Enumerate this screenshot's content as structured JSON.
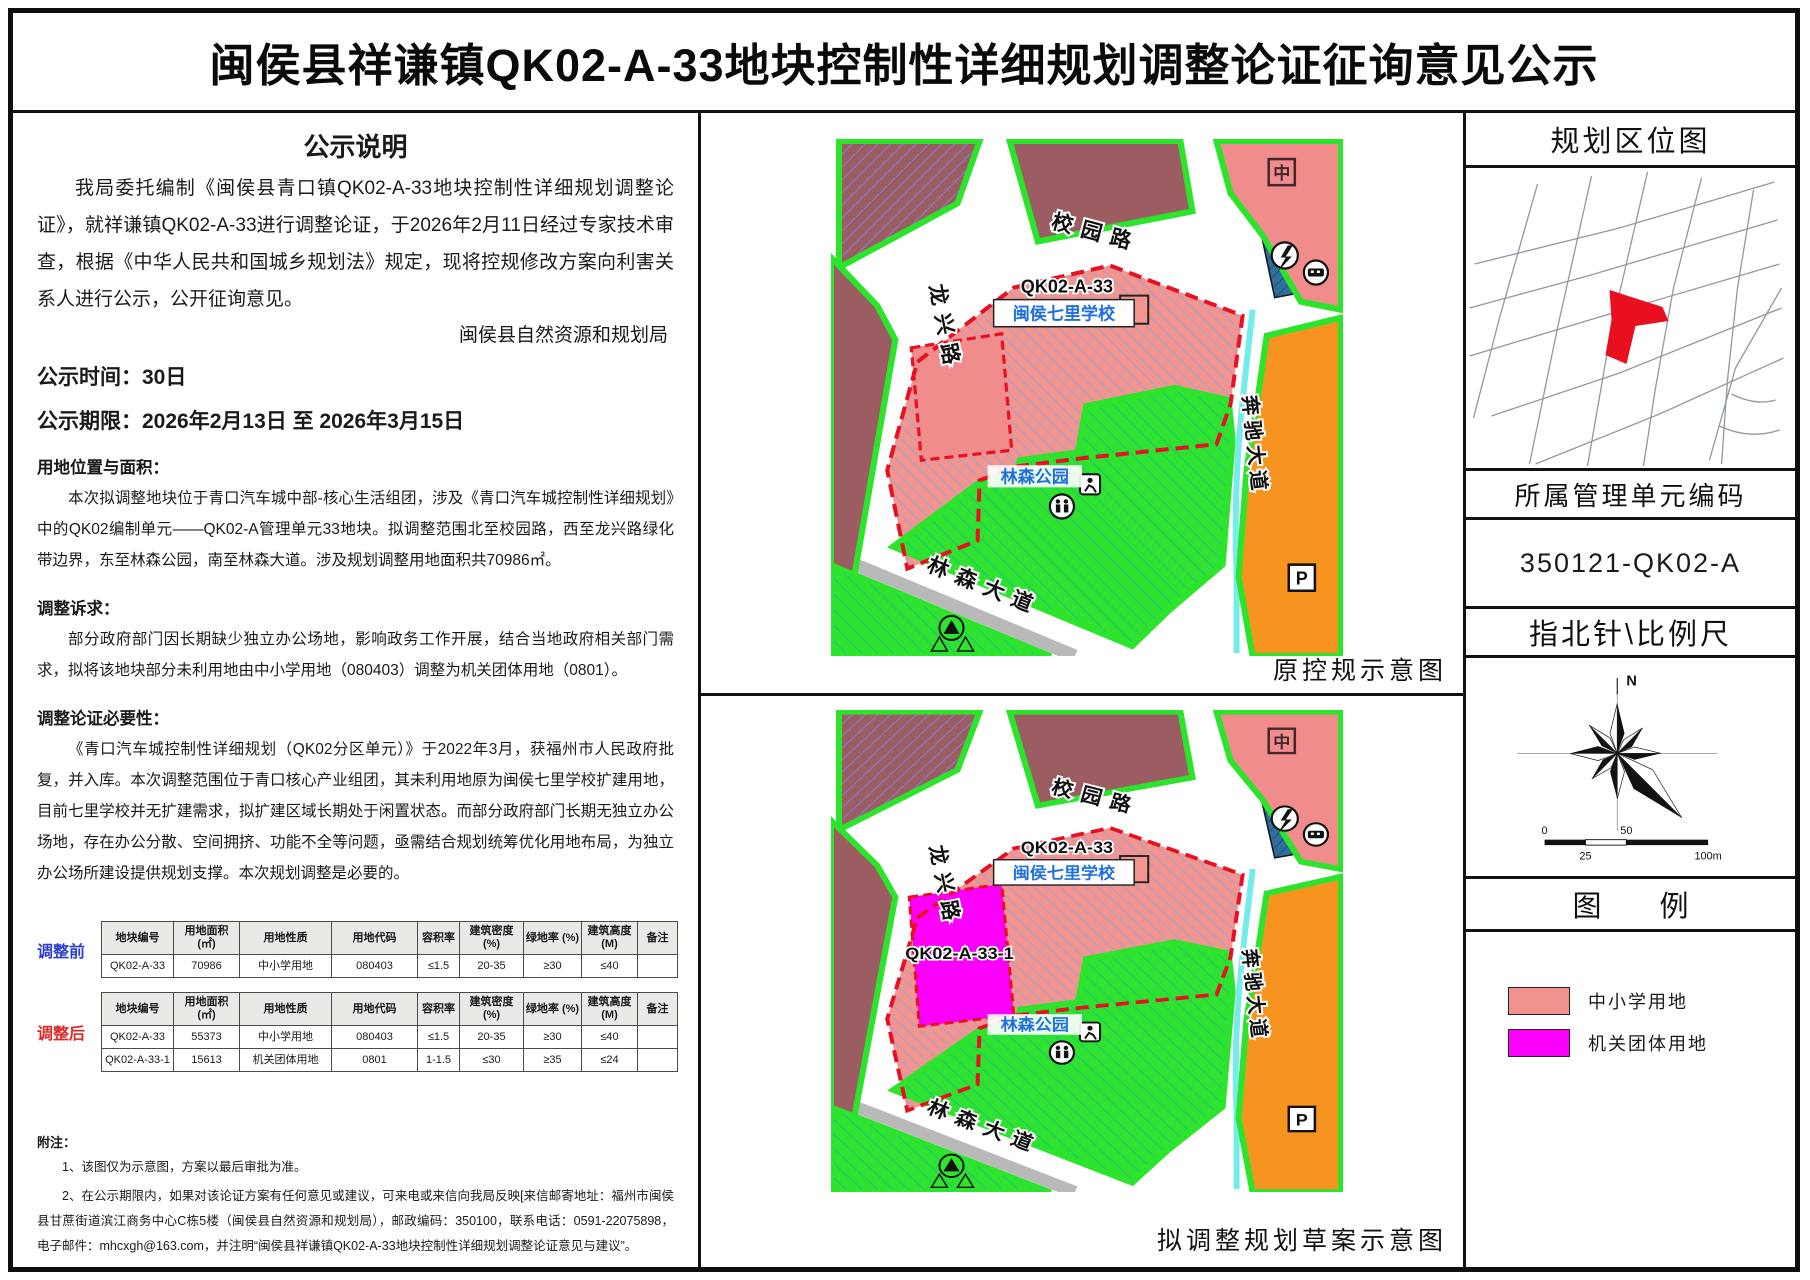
{
  "title": "闽侯县祥谦镇QK02-A-33地块控制性详细规划调整论证征询意见公示",
  "left": {
    "heading": "公示说明",
    "para1": "我局委托编制《闽侯县青口镇QK02-A-33地块控制性详细规划调整论证》，就祥谦镇QK02-A-33进行调整论证，于2026年2月11日经过专家技术审查，根据《中华人民共和国城乡规划法》规定，现将控规修改方案向利害关系人进行公示，公开征询意见。",
    "signature": "闽侯县自然资源和规划局",
    "time": "公示时间：30日",
    "period": "公示期限：2026年2月13日 至 2026年3月15日",
    "s1_title": "用地位置与面积：",
    "s1_body": "本次拟调整地块位于青口汽车城中部-核心生活组团，涉及《青口汽车城控制性详细规划》中的QK02编制单元——QK02-A管理单元33地块。拟调整范围北至校园路，西至龙兴路绿化带边界，东至林森公园，南至林森大道。涉及规划调整用地面积共70986㎡。",
    "s2_title": "调整诉求：",
    "s2_body": "部分政府部门因长期缺少独立办公场地，影响政务工作开展，结合当地政府相关部门需求，拟将该地块部分未利用地由中小学用地（080403）调整为机关团体用地（0801）。",
    "s3_title": "调整论证必要性：",
    "s3_body": "《青口汽车城控制性详细规划（QK02分区单元）》于2022年3月，获福州市人民政府批复，并入库。本次调整范围位于青口核心产业组团，其未利用地原为闽侯七里学校扩建用地，目前七里学校并无扩建需求，拟扩建区域长期处于闲置状态。而部分政府部门长期无独立办公场地，存在办公分散、空间拥挤、功能不全等问题，亟需结合规划统筹优化用地布局，为独立办公场所建设提供规划支撑。本次规划调整是必要的。",
    "tables": {
      "before_label": "调整前",
      "after_label": "调整后",
      "headers": [
        "地块编号",
        "用地面积 (㎡)",
        "用地性质",
        "用地代码",
        "容积率",
        "建筑密度 (%)",
        "绿地率 (%)",
        "建筑高度 (M)",
        "备注"
      ],
      "before_rows": [
        [
          "QK02-A-33",
          "70986",
          "中小学用地",
          "080403",
          "≤1.5",
          "20-35",
          "≥30",
          "≤40",
          ""
        ]
      ],
      "after_rows": [
        [
          "QK02-A-33",
          "55373",
          "中小学用地",
          "080403",
          "≤1.5",
          "20-35",
          "≥30",
          "≤40",
          ""
        ],
        [
          "QK02-A-33-1",
          "15613",
          "机关团体用地",
          "0801",
          "1-1.5",
          "≤30",
          "≥35",
          "≤24",
          ""
        ]
      ]
    },
    "notes_title": "附注：",
    "notes": [
      "1、该图仅为示意图，方案以最后审批为准。",
      "2、在公示期限内，如果对该论证方案有任何意见或建议，可来电或来信向我局反映[来信邮寄地址：福州市闽侯县甘蔗街道滨江商务中心C栋5楼（闽侯县自然资源和规划局），邮政编码：350100，联系电话：0591-22075898，电子邮件：mhcxgh@163.com，并注明“闽侯县祥谦镇QK02-A-33地块控制性详细规划调整论证意见与建议”。",
      "3、如要求听证，应在公示期限内书面向我局提出申请。"
    ]
  },
  "maps": {
    "top_caption": "原控规示意图",
    "bottom_caption": "拟调整规划草案示意图",
    "labels": {
      "xiaoyuan_road": "校园路",
      "longxing_road": "龙兴路",
      "benchi_avenue": "奔驰大道",
      "linsen_avenue": "林森大道",
      "parcel_code": "QK02-A-33",
      "school_name": "闽侯七里学校",
      "park_name": "林森公园",
      "new_parcel_code": "QK02-A-33-1",
      "school_badge": "中",
      "parking_badge": "P"
    }
  },
  "sidebar": {
    "location_title": "规划区位图",
    "unit_title": "所属管理单元编码",
    "unit_code": "350121-QK02-A",
    "compass_title": "指北针\\比例尺",
    "north_label": "N",
    "scale": {
      "tick0": "0",
      "tick50": "50",
      "tick25": "25",
      "tick100": "100m"
    },
    "legend_title": "图　　例",
    "legend": [
      {
        "label": "中小学用地",
        "color": "#f2928e"
      },
      {
        "label": "机关团体用地",
        "color": "#fa00fa"
      }
    ]
  },
  "colors": {
    "school_land": "#f2928e",
    "government_land": "#fa00fa",
    "park_green": "#2fe22f",
    "residential_maroon": "#9b5d61",
    "commercial_orange": "#f79420",
    "parking_yellow": "#fdda8c",
    "utility_blue": "#2f6f9c",
    "boundary_red": "#e81123",
    "label_blue": "#1f6fe0",
    "water_cyan": "#74ecec",
    "before_label_blue": "#2b3fd0",
    "after_label_red": "#e02a2a"
  }
}
